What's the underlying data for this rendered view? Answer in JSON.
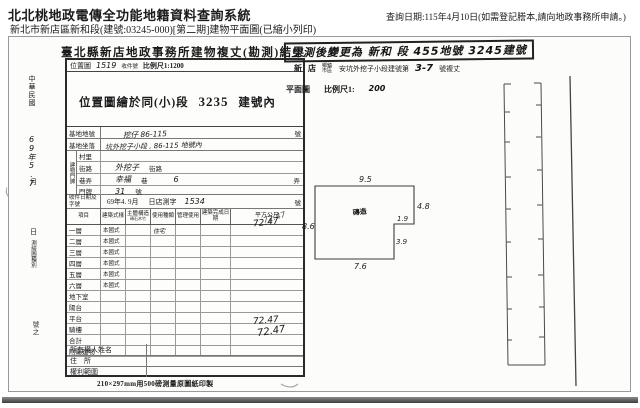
{
  "colors": {
    "ink": "#1b1b1b",
    "scan_border": "#999999",
    "bottom_bar": "#4a4a4a"
  },
  "header": {
    "system_title": "北北桃地政電傳全功能地籍資料查詢系統",
    "query_date": "查詢日期:115年4月10日(如需登記謄本,請向地政事務所申請。)",
    "subtitle": "新北市新店區新和段(建號:03245-000)[第二期]建物平面圖(已縮小列印)"
  },
  "scan": {
    "form": {
      "title": "臺北縣新店地政事務所建物複丈(勘測)結果",
      "margin": {
        "era": "中華民國",
        "date": "69年5.7",
        "month": "月",
        "day": "日",
        "small": "測繪圖種別",
        "no": "號之"
      },
      "loc_header": {
        "label": "位置圖",
        "number": "1519",
        "receipt": "收件號",
        "scale": "比例尺1:1200"
      },
      "loc_text": {
        "part1": "位置圖繪於同(小)段",
        "number": "3235",
        "part2": "建號內"
      },
      "fields": {
        "lot_label": "基地地號",
        "lot_value": "挖仔 86-115",
        "lot_suffix": "號",
        "site_label": "基地坐落",
        "site_value": "坑外挖子小段 , 86-115 地號內",
        "addr_group_label": "建物門牌",
        "addr": [
          {
            "label": "村里",
            "hw1": "",
            "p1": "",
            "hw2": "",
            "p2": ""
          },
          {
            "label": "街路",
            "hw1": "外挖子",
            "p1": "街路",
            "hw2": "",
            "p2": ""
          },
          {
            "label": "巷弄",
            "hw1": "幸福",
            "p1": "巷",
            "hw2": "6",
            "p2": "弄"
          },
          {
            "label": "門牌",
            "hw1": "31",
            "p1": "號",
            "hw2": "",
            "p2": ""
          }
        ],
        "receipt_label": "收件日期及字號",
        "receipt_value": "69年4. 9月",
        "receipt_mid": "日店測字",
        "receipt_no": "1534",
        "receipt_suffix": "號"
      },
      "table": {
        "headers": [
          "項目",
          "建築式樣",
          "主體構造",
          "使用種類",
          "管理使用",
          "建築完成日期",
          "平方公尺"
        ],
        "construction_sub": "磚石木竹",
        "rows": [
          {
            "label": "一層",
            "style": "本國式",
            "use": "住宅"
          },
          {
            "label": "二層",
            "style": "本國式",
            "use": ""
          },
          {
            "label": "三層",
            "style": "本國式",
            "use": ""
          },
          {
            "label": "四層",
            "style": "本國式",
            "use": ""
          },
          {
            "label": "五層",
            "style": "本國式",
            "use": ""
          },
          {
            "label": "六層",
            "style": "本國式",
            "use": ""
          },
          {
            "label": "地下室",
            "style": "",
            "use": ""
          },
          {
            "label": "陽台",
            "style": "",
            "use": ""
          },
          {
            "label": "平台",
            "style": "",
            "use": ""
          },
          {
            "label": "騎樓",
            "style": "",
            "use": ""
          },
          {
            "label": "合計",
            "style": "",
            "use": ""
          },
          {
            "label": "附屬建物",
            "style": "",
            "use": ""
          }
        ],
        "hw_area_floor1": "72.47",
        "hw_area_total": "72.47",
        "hw_area_total2": "72.47"
      },
      "owner_rows": [
        "所有權人姓名",
        "住　所",
        "權利範圍"
      ],
      "footer_note": "210×297mm用500磅測量原圖紙印製"
    },
    "plan": {
      "stamp": "空測後變更為 新和 段 455地號 3245建號",
      "line1": {
        "s1": "新",
        "s2": "店",
        "s3": "鄉鎮市區",
        "s4": "安坑外挖子小段建號第",
        "s5": "3-7",
        "s6": "號複丈"
      },
      "plan_label": "平面圖",
      "scale_label": "比例尺1:",
      "scale_value": "200",
      "dims": {
        "top": "9.5",
        "left": "8.6",
        "right": "4.8",
        "notch_w": "1.9",
        "notch_h": "3.9",
        "bottom": "7.6"
      },
      "center_mark": "磚造"
    }
  }
}
